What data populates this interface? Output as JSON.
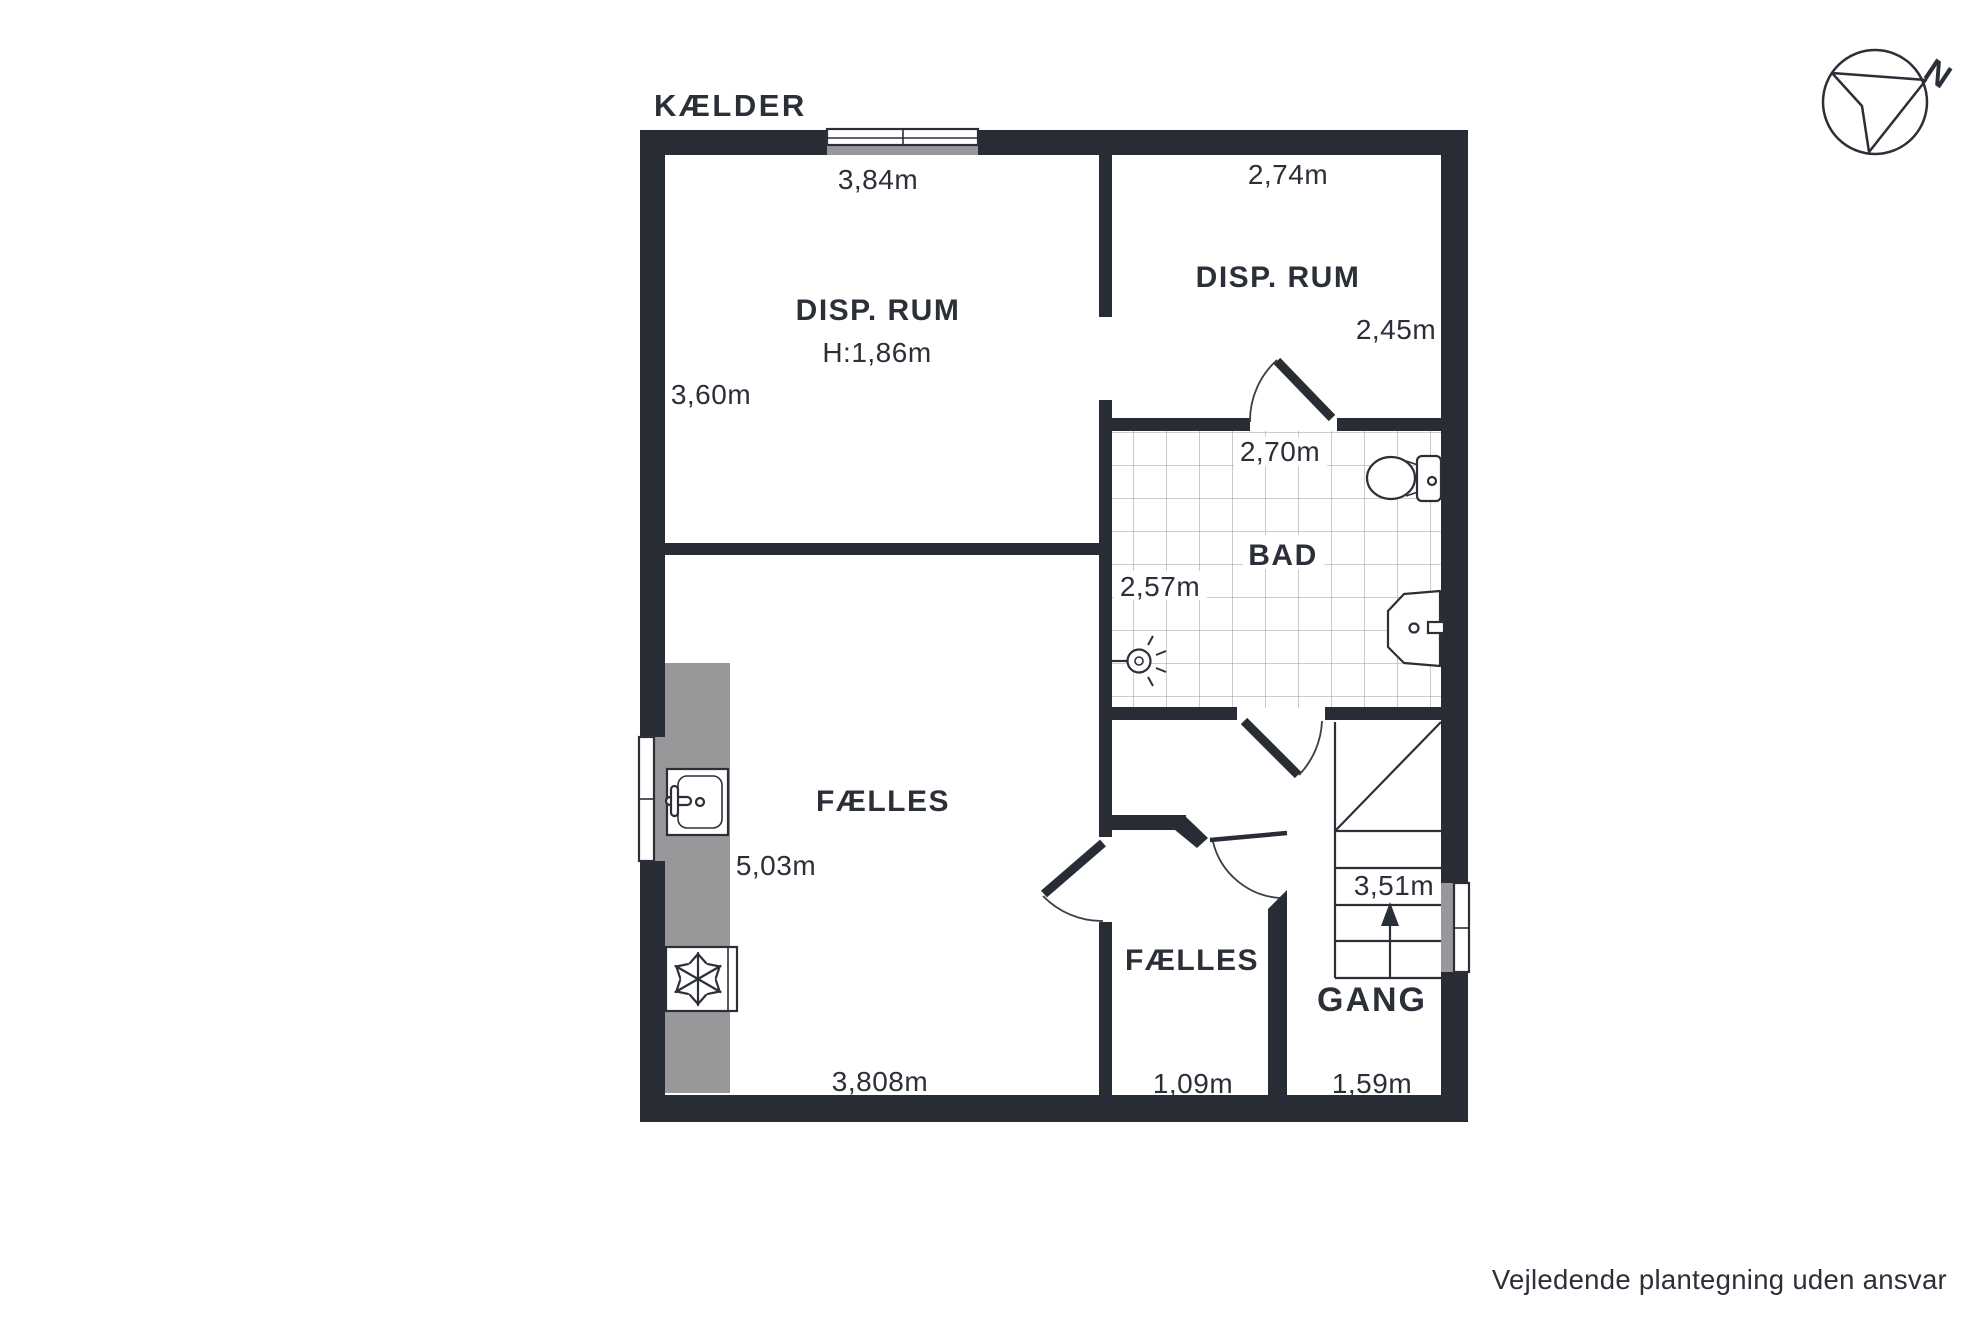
{
  "title": "KÆLDER",
  "disclaimer": "Vejledende plantegning uden ansvar",
  "compass": {
    "north_label": "N"
  },
  "rooms": {
    "disp_left": {
      "label": "DISP. RUM",
      "height_note": "H:1,86m"
    },
    "disp_right": {
      "label": "DISP. RUM"
    },
    "bad": {
      "label": "BAD"
    },
    "faelles_main": {
      "label": "FÆLLES"
    },
    "faelles_small": {
      "label": "FÆLLES"
    },
    "gang": {
      "label": "GANG"
    }
  },
  "measurements": {
    "disp_left_width": "3,84m",
    "disp_left_depth": "3,60m",
    "disp_right_width": "2,74m",
    "disp_right_depth": "2,45m",
    "bad_width": "2,70m",
    "bad_depth": "2,57m",
    "faelles_main_depth": "5,03m",
    "faelles_main_width": "3,808m",
    "faelles_small_width": "1,09m",
    "gang_width": "1,59m",
    "stairs_run": "3,51m"
  },
  "colors": {
    "wall": "#282c34",
    "window_gray": "#98989a",
    "tile_line": "#9e9e9e",
    "text": "#2b2f38",
    "background": "#ffffff"
  }
}
